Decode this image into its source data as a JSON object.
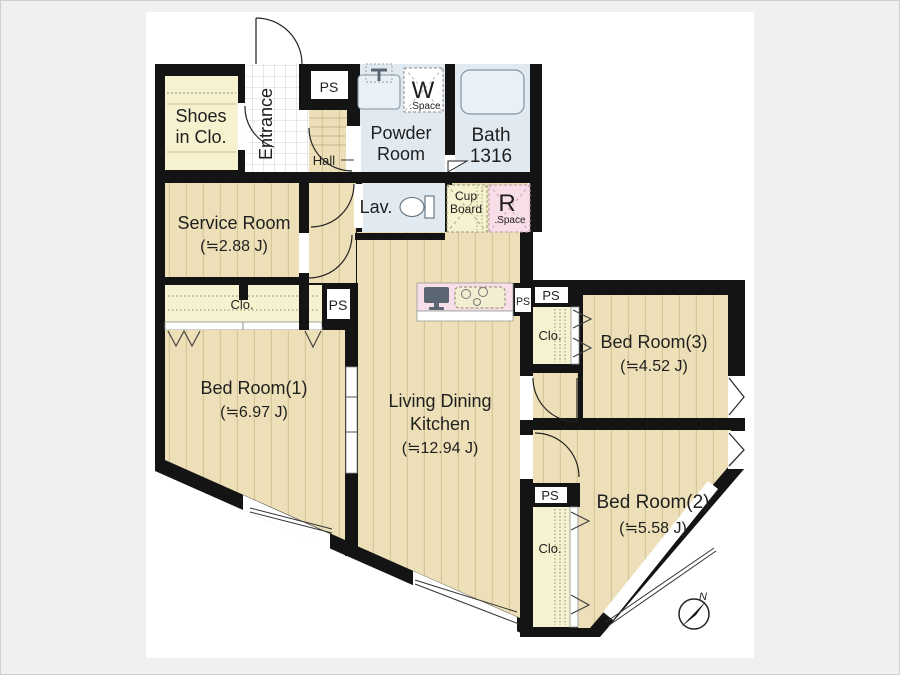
{
  "title": "Apartment floor plan",
  "colors": {
    "wall": "#141414",
    "floor_beige": "#EDE0B8",
    "floor_stripe": "#D6C79B",
    "closet_cream": "#F6F1CE",
    "wet_room_blue": "#E1EAF1",
    "fixture_blue": "#EAF1F6",
    "pink": "#F8DEE9",
    "canvas": "#FFFFFF",
    "page_background": "#F0F0EF"
  },
  "labels": {
    "ps": "PS",
    "closet": "Clo."
  },
  "rooms": {
    "shoes_closet": {
      "line1": "Shoes",
      "line2": "in Clo."
    },
    "entrance": {
      "label": "Entrance"
    },
    "hall": {
      "label": "Hall"
    },
    "powder_room": {
      "line1": "Powder",
      "line2": "Room"
    },
    "washer_space": {
      "initial": "W",
      "caption": ".Space"
    },
    "bath": {
      "line1": "Bath",
      "line2": "1316"
    },
    "lavatory": {
      "label": "Lav."
    },
    "cupboard": {
      "line1": "Cup",
      "line2": "Board"
    },
    "refrigerator_space": {
      "initial": "R",
      "caption": ".Space"
    },
    "service_room": {
      "name": "Service Room",
      "area": "(≒2.88 J)"
    },
    "bedroom1": {
      "name": "Bed Room(1)",
      "area": "(≒6.97 J)"
    },
    "ldk": {
      "line1": "Living Dining",
      "line2": "Kitchen",
      "area": "(≒12.94 J)"
    },
    "bedroom3": {
      "name": "Bed Room(3)",
      "area": "(≒4.52 J)"
    },
    "bedroom2": {
      "name": "Bed Room(2)",
      "area": "(≒5.58 J)"
    }
  },
  "compass": {
    "label": "N"
  }
}
